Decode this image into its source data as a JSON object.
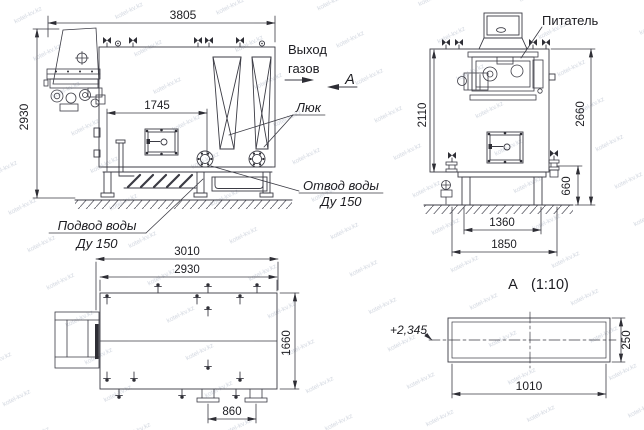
{
  "watermark": {
    "text": "kotel-kv.kz"
  },
  "colors": {
    "line": "#3b3b44",
    "text": "#1d1d22",
    "fill_dark": "#2e2e35",
    "watermark": "#9aa4b8",
    "background": "#ffffff"
  },
  "views": {
    "side": {
      "dim_overall_width": "3805",
      "dim_overall_height": "2930",
      "dim_hatch_span": "1745",
      "label_gas_outlet_line1": "Выход",
      "label_gas_outlet_line2": "газов",
      "label_section_arrow": "А",
      "label_manhole": "Люк",
      "label_water_outlet_line1": "Отвод воды",
      "label_water_outlet_line2": "Ду 150",
      "label_water_inlet_line1": "Подвод воды",
      "label_water_inlet_line2": "Ду 150"
    },
    "front": {
      "label_feeder": "Питатель",
      "dim_body_height": "2110",
      "dim_overall_height": "2660",
      "dim_base_height": "660",
      "dim_base_width": "1360",
      "dim_foundation_width": "1850"
    },
    "plan": {
      "dim_overall_length": "3010",
      "dim_body_length": "2930",
      "dim_body_width": "1660",
      "dim_drain_spacing": "860"
    },
    "section": {
      "label_view": "А",
      "label_scale": "(1:10)",
      "label_elevation": "+2,345",
      "dim_height": "250",
      "dim_width": "1010"
    }
  }
}
